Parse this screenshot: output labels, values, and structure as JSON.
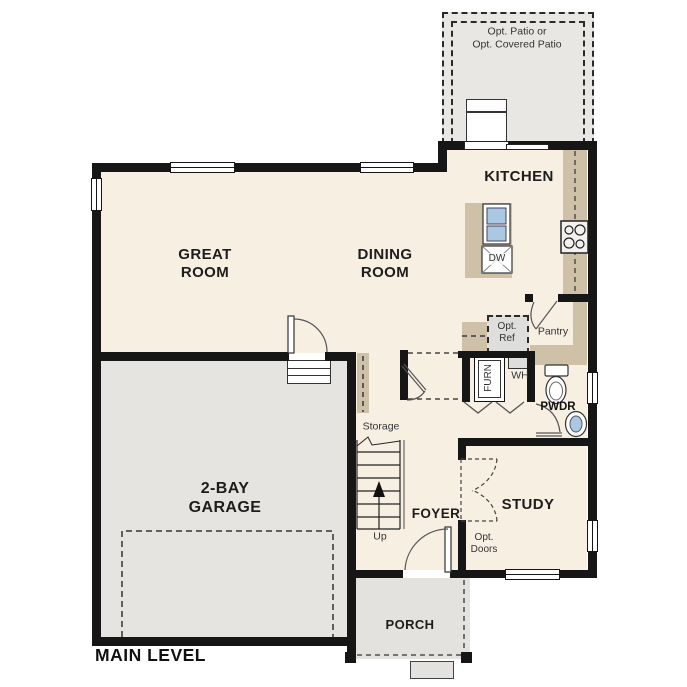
{
  "plan": {
    "level_label": "MAIN LEVEL",
    "rooms": {
      "patio": {
        "label_line1": "Opt. Patio or",
        "label_line2": "Opt. Covered Patio"
      },
      "kitchen": {
        "label": "KITCHEN"
      },
      "great_room": {
        "label_line1": "GREAT",
        "label_line2": "ROOM"
      },
      "dining_room": {
        "label_line1": "DINING",
        "label_line2": "ROOM"
      },
      "garage": {
        "label_line1": "2-BAY",
        "label_line2": "GARAGE"
      },
      "study": {
        "label": "STUDY"
      },
      "foyer": {
        "label": "FOYER"
      },
      "porch": {
        "label": "PORCH"
      },
      "pantry": {
        "label": "Pantry"
      },
      "powder_room": {
        "label": "PWDR"
      },
      "storage": {
        "label": "Storage"
      }
    },
    "annotations": {
      "stairs_up": "Up",
      "opt_ref_line1": "Opt.",
      "opt_ref_line2": "Ref",
      "opt_doors_line1": "Opt.",
      "opt_doors_line2": "Doors",
      "dishwasher": "DW",
      "furnace": "FURN",
      "water_heater": "WH"
    },
    "symbols": {
      "toilet": "toilet-plan-symbol",
      "powder_sink": "oval-sink-symbol",
      "island_sink": "double-basin-sink-symbol",
      "cooktop": "four-burner-cooktop-symbol",
      "dishwasher": "x-box-symbol",
      "stairs": "stair-run-with-up-arrow",
      "garage_door": "dashed-garage-door-outline",
      "optional_doors": "dashed-double-door-arcs"
    },
    "colors": {
      "wall": "#161616",
      "living_floor": "#f7efe2",
      "garage_floor": "#e5e4e1",
      "porch_floor": "#e3e2df",
      "patio_floor": "#e8e7e4",
      "cabinet_tan": "#cec1a8",
      "fixture_gray": "#dededc",
      "sink_blue": "#aac7e3"
    }
  }
}
